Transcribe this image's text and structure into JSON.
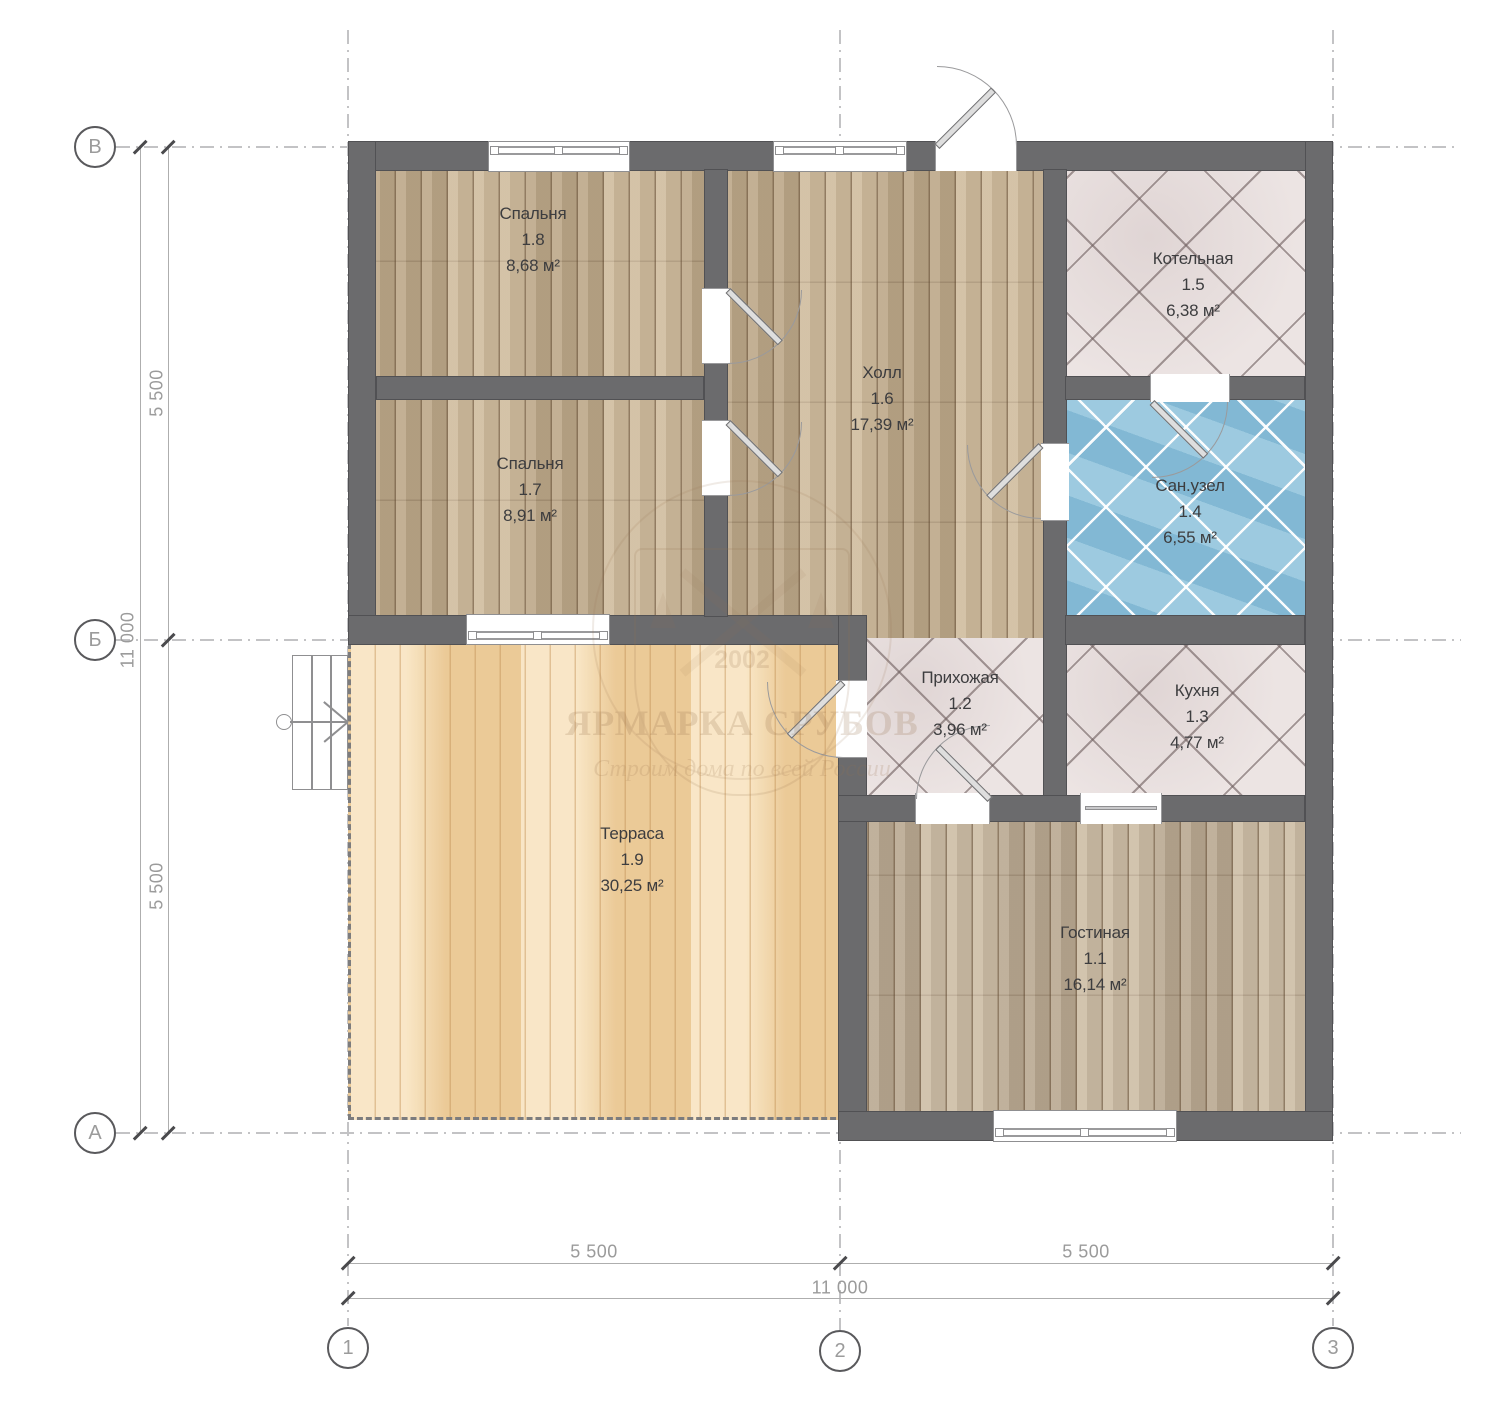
{
  "axes": {
    "rows": [
      {
        "label": "В"
      },
      {
        "label": "Б"
      },
      {
        "label": "А"
      }
    ],
    "cols": [
      {
        "label": "1"
      },
      {
        "label": "2"
      },
      {
        "label": "3"
      }
    ]
  },
  "dims": {
    "left": [
      "5 500",
      "11 000",
      "5 500"
    ],
    "bottom": [
      "5 500",
      "5 500",
      "11 000"
    ]
  },
  "rooms": [
    {
      "name": "Спальня",
      "number": "1.8",
      "area": "8,68 м²"
    },
    {
      "name": "Спальня",
      "number": "1.7",
      "area": "8,91 м²"
    },
    {
      "name": "Холл",
      "number": "1.6",
      "area": "17,39 м²"
    },
    {
      "name": "Котельная",
      "number": "1.5",
      "area": "6,38 м²"
    },
    {
      "name": "Сан.узел",
      "number": "1.4",
      "area": "6,55 м²"
    },
    {
      "name": "Прихожая",
      "number": "1.2",
      "area": "3,96 м²"
    },
    {
      "name": "Кухня",
      "number": "1.3",
      "area": "4,77 м²"
    },
    {
      "name": "Терраса",
      "number": "1.9",
      "area": "30,25 м²"
    },
    {
      "name": "Гостиная",
      "number": "1.1",
      "area": "16,14 м²"
    }
  ],
  "watermark": {
    "year": "2002",
    "title": "ЯРМАРКА СРУБОВ",
    "subtitle": "Строим дома по всей России"
  },
  "colors": {
    "wall": "#6b6b6d",
    "wood": "#c9b494",
    "terrace": "#f2d8ac",
    "tile_light": "#ece4e3",
    "tile_blue": "#8ac0da"
  }
}
